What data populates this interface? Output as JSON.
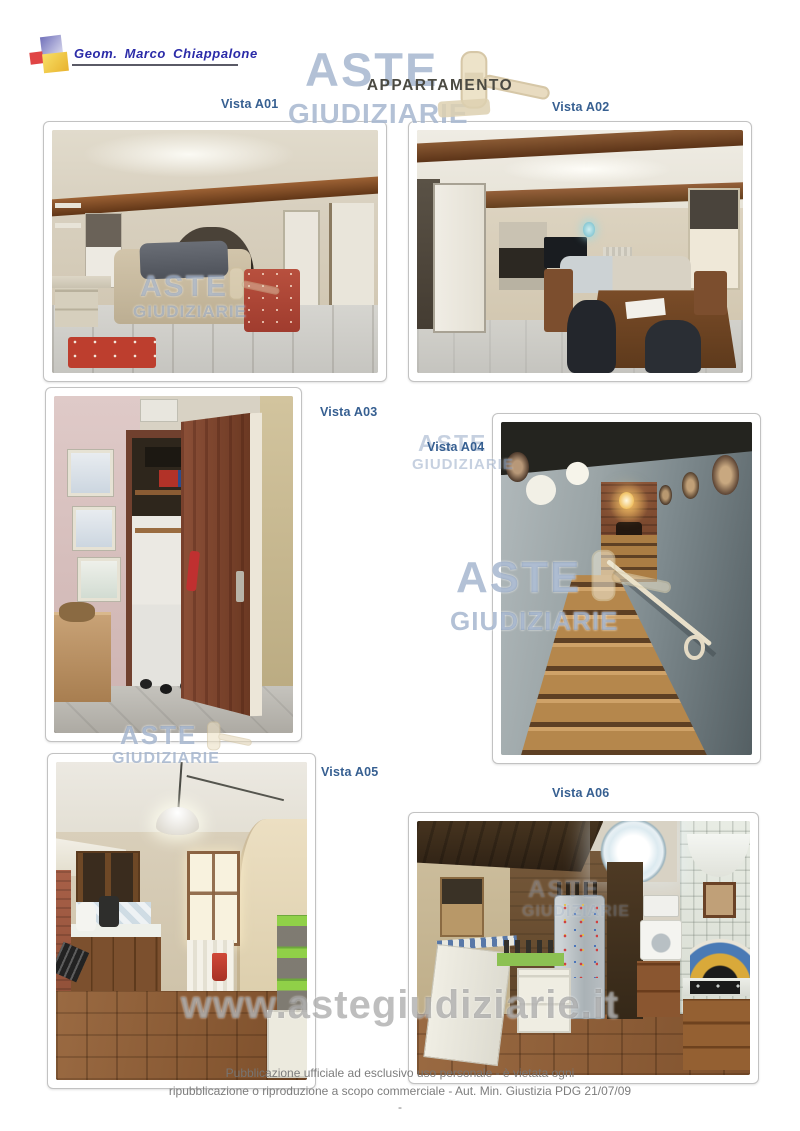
{
  "header": {
    "author": "Geom. Marco Chiappalone"
  },
  "title": "APPARTAMENTO",
  "photos": [
    {
      "id": "A01",
      "label": "Vista A01"
    },
    {
      "id": "A02",
      "label": "Vista A02"
    },
    {
      "id": "A03",
      "label": "Vista A03"
    },
    {
      "id": "A04",
      "label": "Vista A04"
    },
    {
      "id": "A05",
      "label": "Vista A05"
    },
    {
      "id": "A06",
      "label": "Vista A06"
    }
  ],
  "watermark": {
    "word1": "ASTE",
    "word2": "GIUDIZIARIE",
    "site": "www.astegiudiziarie.it"
  },
  "footer": {
    "line1": "Pubblicazione ufficiale ad esclusivo uso personale - è vietata ogni",
    "line2": "ripubblicazione o riproduzione a scopo commerciale - Aut. Min. Giustizia PDG 21/07/09",
    "page_mark": "-"
  },
  "colors": {
    "label_blue": "#365F91",
    "watermark_blue": "#7C94B9",
    "author_blue": "#2B2BA8",
    "title_gray": "#4B4A42"
  }
}
